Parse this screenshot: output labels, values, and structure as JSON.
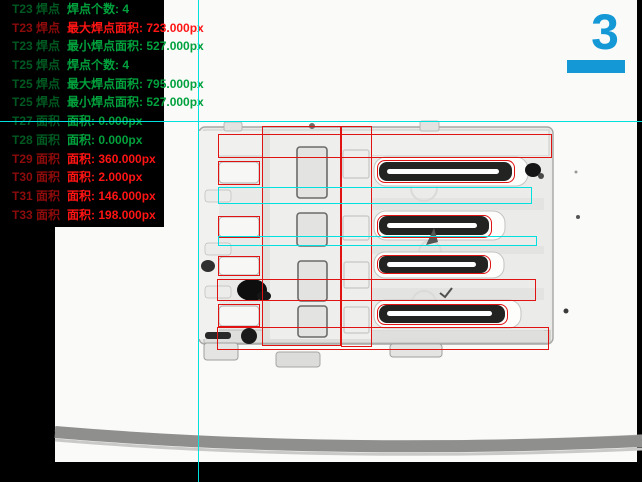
{
  "panel": {
    "pass_color": "#00A13C",
    "fail_color": "#FF1414",
    "lines": [
      {
        "tool": "T23 焊点",
        "text": "焊点个数: 4",
        "status": "pass"
      },
      {
        "tool": "T23 焊点",
        "text": "最大焊点面积: 723.000px",
        "status": "fail"
      },
      {
        "tool": "T23 焊点",
        "text": "最小焊点面积: 527.000px",
        "status": "pass"
      },
      {
        "tool": "T25 焊点",
        "text": "焊点个数: 4",
        "status": "pass"
      },
      {
        "tool": "T25 焊点",
        "text": "最大焊点面积: 795.000px",
        "status": "pass"
      },
      {
        "tool": "T25 焊点",
        "text": "最小焊点面积: 527.000px",
        "status": "pass"
      },
      {
        "tool": "T27 面积",
        "text": "面积: 0.000px",
        "status": "pass"
      },
      {
        "tool": "T28 面积",
        "text": "面积: 0.000px",
        "status": "pass"
      },
      {
        "tool": "T29 面积",
        "text": "面积: 360.000px",
        "status": "fail"
      },
      {
        "tool": "T30 面积",
        "text": "面积: 2.000px",
        "status": "fail"
      },
      {
        "tool": "T31 面积",
        "text": "面积: 146.000px",
        "status": "fail"
      },
      {
        "tool": "T33 面积",
        "text": "面积: 198.000px",
        "status": "fail"
      }
    ]
  },
  "station_indicator": {
    "number": "3",
    "color": "#1598D6"
  },
  "crosshair": {
    "x": 198,
    "y": 121,
    "color": "#00E0E0"
  },
  "overlay": {
    "red_color": "#E01212",
    "cyan_color": "#00E0E0",
    "red_rects": [
      {
        "name": "roi-top-shell-band",
        "x": 218,
        "y": 134,
        "w": 334,
        "h": 24,
        "r": 0
      },
      {
        "name": "roi-center-left",
        "x": 262,
        "y": 126,
        "w": 79,
        "h": 220,
        "r": 0
      },
      {
        "name": "roi-center-right",
        "x": 341,
        "y": 126,
        "w": 31,
        "h": 221,
        "r": 0
      },
      {
        "name": "roi-solder-contact-1",
        "x": 218,
        "y": 161,
        "w": 42,
        "h": 24,
        "r": 0
      },
      {
        "name": "roi-solder-contact-2",
        "x": 218,
        "y": 216,
        "w": 42,
        "h": 22,
        "r": 0
      },
      {
        "name": "roi-solder-contact-3",
        "x": 218,
        "y": 256,
        "w": 42,
        "h": 20,
        "r": 0
      },
      {
        "name": "roi-solder-contact-4",
        "x": 218,
        "y": 304,
        "w": 42,
        "h": 23,
        "r": 0
      },
      {
        "name": "roi-middle-band",
        "x": 217,
        "y": 279,
        "w": 319,
        "h": 22,
        "r": 0
      },
      {
        "name": "roi-bottom-band",
        "x": 217,
        "y": 327,
        "w": 332,
        "h": 23,
        "r": 0
      },
      {
        "name": "roi-pin-1",
        "x": 377,
        "y": 160,
        "w": 138,
        "h": 23,
        "r": 8
      },
      {
        "name": "roi-pin-2",
        "x": 377,
        "y": 215,
        "w": 115,
        "h": 23,
        "r": 8
      },
      {
        "name": "roi-pin-3",
        "x": 377,
        "y": 255,
        "w": 114,
        "h": 19,
        "r": 8
      },
      {
        "name": "roi-pin-4",
        "x": 377,
        "y": 304,
        "w": 131,
        "h": 21,
        "r": 8
      }
    ],
    "cyan_rects": [
      {
        "name": "measure-rect-1",
        "x": 218,
        "y": 187,
        "w": 314,
        "h": 17
      },
      {
        "name": "measure-rect-2",
        "x": 218,
        "y": 236,
        "w": 319,
        "h": 10
      }
    ]
  }
}
